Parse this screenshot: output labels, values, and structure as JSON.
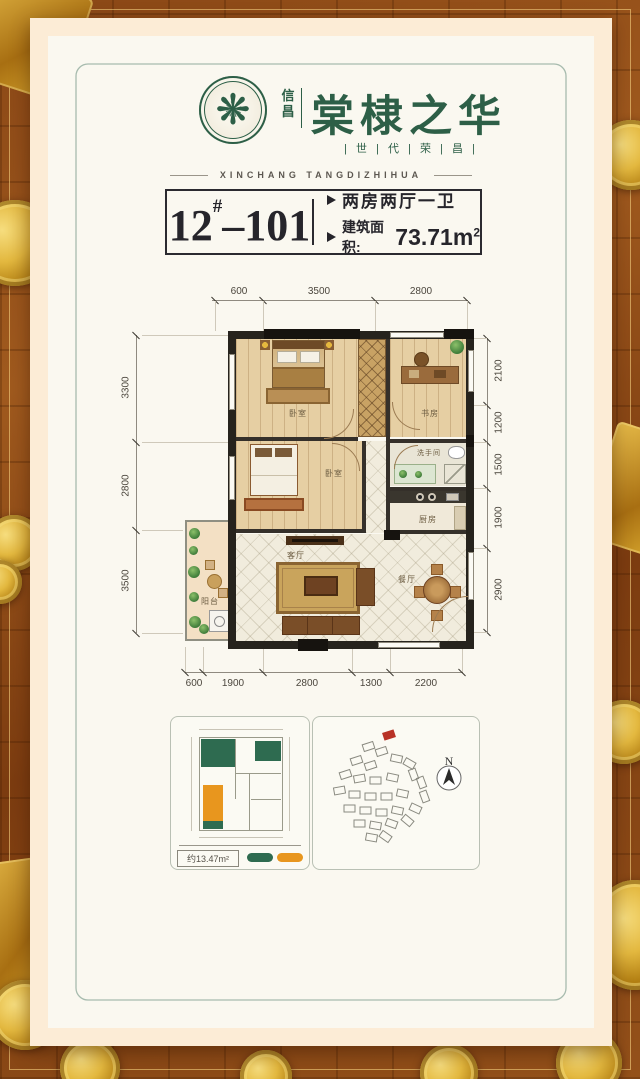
{
  "brand": {
    "name_vertical": "信昌",
    "name_main": "棠棣之华",
    "tagline": "| 世 | 代 | 荣 | 昌 |",
    "subtitle_en": "XINCHANG TANGDIZHIHUA"
  },
  "unit": {
    "block": "12",
    "block_sup": "#",
    "dash": "–",
    "room": "101",
    "feature": "两房两厅一卫",
    "area_label": "建筑面积:",
    "area_value": "73.71m",
    "area_sup": "2"
  },
  "floorplan": {
    "dims_top": [
      "600",
      "3500",
      "2800"
    ],
    "dims_bottom": [
      "600",
      "1900",
      "2800",
      "1300",
      "2200"
    ],
    "dims_left": [
      "3300",
      "2800",
      "3500"
    ],
    "dims_right": [
      "2100",
      "1200",
      "1500",
      "1900",
      "2900"
    ],
    "rooms": {
      "bedroom1": "卧室",
      "study": "书房",
      "bedroom2": "卧室",
      "bathroom": "洗手间",
      "kitchen": "厨房",
      "living": "客厅",
      "dining": "餐厅",
      "balcony": "阳台"
    }
  },
  "mini_plan": {
    "legend_area": "约13.47m²"
  },
  "site_plan": {
    "north": "N"
  },
  "colors": {
    "brand_green": "#2d5f47",
    "accent_orange": "#e8961e",
    "mini_green": "#2e6b50",
    "highlight_red": "#b83226"
  }
}
